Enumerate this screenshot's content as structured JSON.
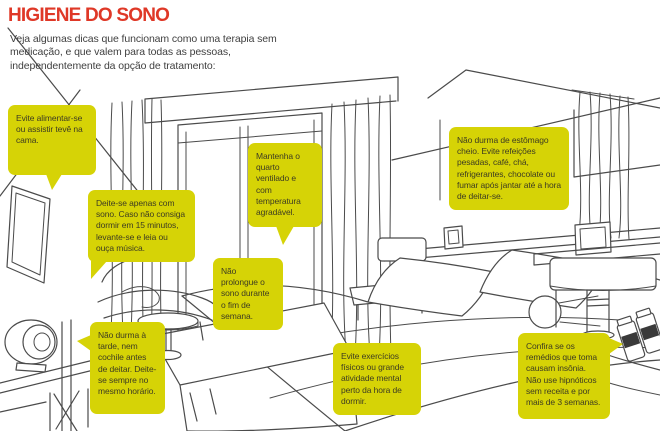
{
  "header": {
    "title": "HIGIENE DO SONO",
    "intro": "Veja algumas dicas que funcionam como uma terapia sem medicação, e que valem para todas as pessoas, independentemente da opção de tratamento:"
  },
  "colors": {
    "title": "#df3827",
    "callout_bg": "#d6d306",
    "callout_text": "#3d3c22",
    "sketch_line": "#4b4b4b"
  },
  "callouts": [
    {
      "id": "tv",
      "text": "Evite alimentar-se ou assistir tevê na cama."
    },
    {
      "id": "sleep-only",
      "text": "Deite-se apenas com sono. Caso não consiga dormir em 15 minutos, levante-se e leia ou ouça música."
    },
    {
      "id": "ventilation",
      "text": "Mantenha o quarto ventilado e com temperatura agradável."
    },
    {
      "id": "weekend",
      "text": "Não prolongue o sono durante o fim de semana."
    },
    {
      "id": "nap",
      "text": "Não durma à tarde, nem cochile antes de deitar. Deite-se sempre no mesmo horário."
    },
    {
      "id": "exercise",
      "text": "Evite exercícios físicos ou grande atividade mental perto da hora de dormir."
    },
    {
      "id": "meals",
      "text": "Não durma de estômago cheio. Evite refeições pesadas, café, chá, refrigerantes, chocolate ou fumar após jantar até a hora de deitar-se."
    },
    {
      "id": "medicines",
      "text": "Confira se os remédios que toma causam insônia. Não use hipnóticos sem receita e por mais de 3 semanas."
    }
  ]
}
